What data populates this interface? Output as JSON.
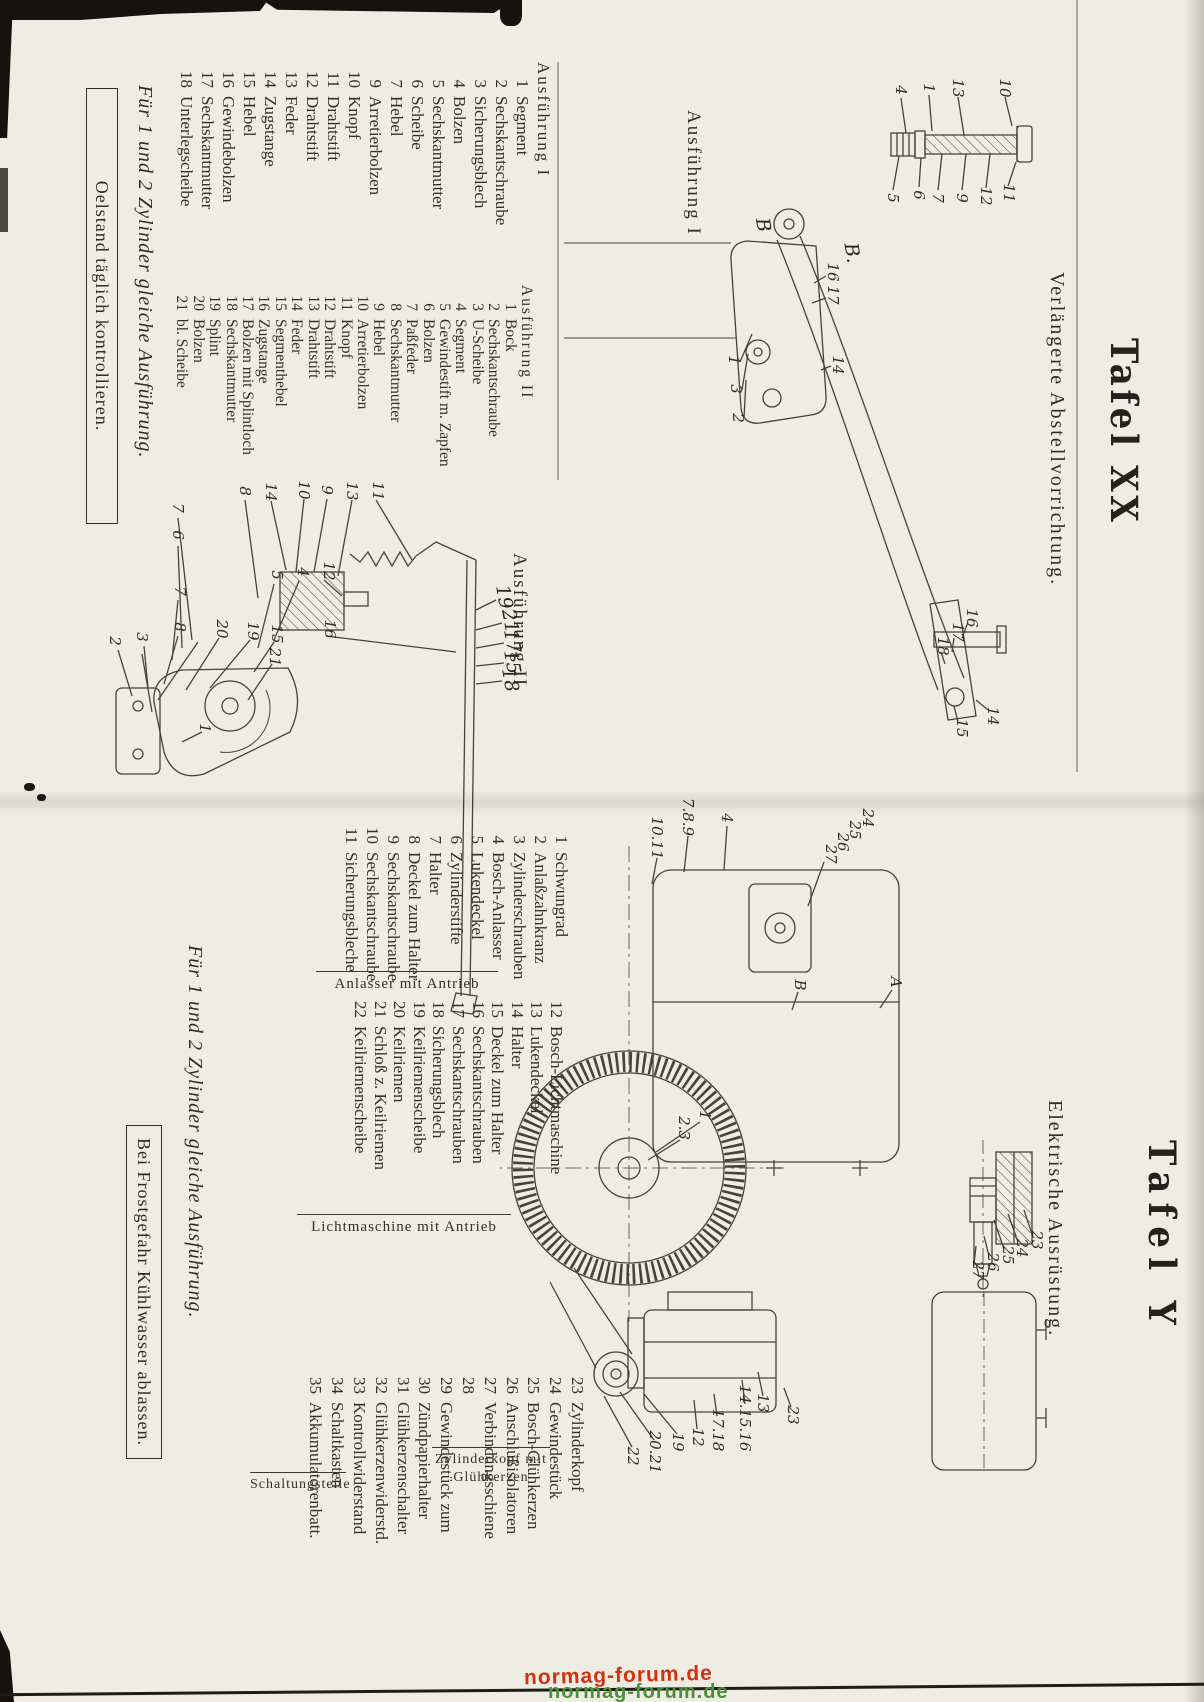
{
  "watermark": {
    "text": "normag-forum.de",
    "red": "#d23110",
    "green": "#4b9138"
  },
  "page_left": {
    "title": "Tafel XX",
    "subtitle": "Verlängerte Abstellvorrichtung.",
    "drawing_labels": {
      "ausf1": "Ausführung I",
      "ausf2": "Ausführung II"
    },
    "list1": {
      "header": "Ausführung I",
      "items": [
        {
          "n": "1",
          "t": "Segment"
        },
        {
          "n": "2",
          "t": "Sechskantschraube"
        },
        {
          "n": "3",
          "t": "Sicherungsblech"
        },
        {
          "n": "4",
          "t": "Bolzen"
        },
        {
          "n": "5",
          "t": "Sechskantmutter"
        },
        {
          "n": "6",
          "t": "Scheibe"
        },
        {
          "n": "7",
          "t": "Hebel"
        },
        {
          "n": "9",
          "t": "Arretierbolzen"
        },
        {
          "n": "10",
          "t": "Knopf"
        },
        {
          "n": "11",
          "t": "Drahtstift"
        },
        {
          "n": "12",
          "t": "Drahtstift"
        },
        {
          "n": "13",
          "t": "Feder"
        },
        {
          "n": "14",
          "t": "Zugstange"
        },
        {
          "n": "15",
          "t": "Hebel"
        },
        {
          "n": "16",
          "t": "Gewindebolzen"
        },
        {
          "n": "17",
          "t": "Sechskantmutter"
        },
        {
          "n": "18",
          "t": "Unterlegscheibe"
        }
      ]
    },
    "list2": {
      "header": "Ausführung II",
      "items": [
        {
          "n": "1",
          "t": "Bock"
        },
        {
          "n": "2",
          "t": "Sechskantschraube"
        },
        {
          "n": "3",
          "t": "U-Scheibe"
        },
        {
          "n": "4",
          "t": "Segment"
        },
        {
          "n": "5",
          "t": "Gewindestift m. Zapfen"
        },
        {
          "n": "6",
          "t": "Bolzen"
        },
        {
          "n": "7",
          "t": "Paßfeder"
        },
        {
          "n": "8",
          "t": "Sechskantmutter"
        },
        {
          "n": "9",
          "t": "Hebel"
        },
        {
          "n": "10",
          "t": "Arretierbolzen"
        },
        {
          "n": "11",
          "t": "Knopf"
        },
        {
          "n": "12",
          "t": "Drahtstift"
        },
        {
          "n": "13",
          "t": "Drahtstift"
        },
        {
          "n": "14",
          "t": "Feder"
        },
        {
          "n": "15",
          "t": "Segmenthebel"
        },
        {
          "n": "16",
          "t": "Zugstange"
        },
        {
          "n": "17",
          "t": "Bolzen mit Splintloch"
        },
        {
          "n": "18",
          "t": "Sechskantmutter"
        },
        {
          "n": "19",
          "t": "Splint"
        },
        {
          "n": "20",
          "t": "Bolzen"
        },
        {
          "n": "21",
          "t": "bl. Scheibe"
        }
      ]
    },
    "note_italic": "Für 1 und 2 Zylinder gleiche Ausführung.",
    "note_boxed": "Oelstand täglich kontrollieren.",
    "callouts": [
      {
        "t": "10",
        "x": 88,
        "y": 199
      },
      {
        "t": "13",
        "x": 88,
        "y": 246
      },
      {
        "t": "1",
        "x": 88,
        "y": 275
      },
      {
        "t": "4",
        "x": 90,
        "y": 303
      },
      {
        "t": "11",
        "x": 193,
        "y": 195
      },
      {
        "t": "12",
        "x": 196,
        "y": 218
      },
      {
        "t": "9",
        "x": 198,
        "y": 242
      },
      {
        "t": "7",
        "x": 198,
        "y": 266
      },
      {
        "t": "6",
        "x": 195,
        "y": 285
      },
      {
        "t": "5",
        "x": 198,
        "y": 311
      },
      {
        "t": "16",
        "x": 272,
        "y": 371
      },
      {
        "t": "17",
        "x": 295,
        "y": 371
      },
      {
        "t": "14",
        "x": 365,
        "y": 366
      },
      {
        "t": "1",
        "x": 360,
        "y": 470
      },
      {
        "t": "3",
        "x": 389,
        "y": 468
      },
      {
        "t": "2",
        "x": 418,
        "y": 466
      },
      {
        "t": "16",
        "x": 618,
        "y": 232
      },
      {
        "t": "17",
        "x": 632,
        "y": 246
      },
      {
        "t": "18",
        "x": 646,
        "y": 261
      },
      {
        "t": "14",
        "x": 716,
        "y": 211
      },
      {
        "t": "15",
        "x": 728,
        "y": 242
      },
      {
        "t": "11",
        "x": 491,
        "y": 826
      },
      {
        "t": "13",
        "x": 491,
        "y": 852
      },
      {
        "t": "9",
        "x": 490,
        "y": 877
      },
      {
        "t": "10",
        "x": 490,
        "y": 900
      },
      {
        "t": "14",
        "x": 492,
        "y": 933
      },
      {
        "t": "8",
        "x": 491,
        "y": 959
      },
      {
        "t": "12",
        "x": 571,
        "y": 875
      },
      {
        "t": "4",
        "x": 572,
        "y": 901
      },
      {
        "t": "5",
        "x": 575,
        "y": 927
      },
      {
        "t": "16",
        "x": 629,
        "y": 874
      },
      {
        "t": "15",
        "x": 634,
        "y": 927
      },
      {
        "t": "19",
        "x": 631,
        "y": 951
      },
      {
        "t": "21",
        "x": 657,
        "y": 929
      },
      {
        "t": "20",
        "x": 629,
        "y": 982
      },
      {
        "t": "7",
        "x": 508,
        "y": 1026
      },
      {
        "t": "6",
        "x": 535,
        "y": 1026
      },
      {
        "t": "7",
        "x": 591,
        "y": 1024
      },
      {
        "t": "8",
        "x": 627,
        "y": 1024
      },
      {
        "t": "3",
        "x": 637,
        "y": 1062
      },
      {
        "t": "2",
        "x": 641,
        "y": 1089
      },
      {
        "t": "1",
        "x": 728,
        "y": 999
      }
    ],
    "hand_marks": [
      {
        "t": "19",
        "x": 597,
        "y": 700
      },
      {
        "t": "21",
        "x": 621,
        "y": 694
      },
      {
        "t": "17",
        "x": 641,
        "y": 692
      },
      {
        "t": "15",
        "x": 662,
        "y": 692
      },
      {
        "t": "18",
        "x": 680,
        "y": 694
      },
      {
        "t": "B",
        "x": 225,
        "y": 441
      },
      {
        "t": "B.",
        "x": 253,
        "y": 352
      }
    ]
  },
  "page_right": {
    "title": "Tafel Y",
    "subtitle": "Elektrische Ausrüstung.",
    "list_starter": {
      "caption": "Anlasser mit Antrieb",
      "items": [
        {
          "n": "1",
          "t": "Schwungrad"
        },
        {
          "n": "2",
          "t": "Anlaßzahnkranz"
        },
        {
          "n": "3",
          "t": "Zylinderschrauben"
        },
        {
          "n": "4",
          "t": "Bosch-Anlasser"
        },
        {
          "n": "5",
          "t": "Lukendeckel"
        },
        {
          "n": "6",
          "t": "Zylinderstifte"
        },
        {
          "n": "7",
          "t": "Halter"
        },
        {
          "n": "8",
          "t": "Deckel zum Halter"
        },
        {
          "n": "9",
          "t": "Sechskantschraube"
        },
        {
          "n": "10",
          "t": "Sechskantschraube"
        },
        {
          "n": "11",
          "t": "Sicherungsbleche"
        }
      ]
    },
    "list_dynamo": {
      "caption": "Lichtmaschine mit Antrieb",
      "items": [
        {
          "n": "12",
          "t": "Bosch-Lichtmaschine"
        },
        {
          "n": "13",
          "t": "Lukendeckel"
        },
        {
          "n": "14",
          "t": "Halter"
        },
        {
          "n": "15",
          "t": "Deckel zum Halter"
        },
        {
          "n": "16",
          "t": "Sechskantschrauben"
        },
        {
          "n": "17",
          "t": "Sechskantschrauben"
        },
        {
          "n": "18",
          "t": "Sicherungsblech"
        },
        {
          "n": "19",
          "t": "Keilriemenscheibe"
        },
        {
          "n": "20",
          "t": "Keilriemen"
        },
        {
          "n": "21",
          "t": "Schloß z. Keilriemen"
        },
        {
          "n": "22",
          "t": "Keilriemenscheibe"
        }
      ]
    },
    "list_parts": {
      "caption_a": "Schaltungsteile",
      "caption_b_line1": "Zylinderkopf mit",
      "caption_b_line2": "Glühkerzen",
      "items": [
        {
          "n": "23",
          "t": "Zylinderkopf"
        },
        {
          "n": "24",
          "t": "Gewindestück"
        },
        {
          "n": "25",
          "t": "Bosch-Glühkerzen"
        },
        {
          "n": "26",
          "t": "Anschlußisolatoren"
        },
        {
          "n": "27",
          "t": "Verbindungsschiene"
        },
        {
          "n": "28",
          "t": ""
        },
        {
          "n": "29",
          "t": "Gewindestück zum"
        },
        {
          "n": "30",
          "t": "Zündpapierhalter"
        },
        {
          "n": "31",
          "t": "Glühkerzenschalter"
        },
        {
          "n": "32",
          "t": "Glühkerzenwiderstd."
        },
        {
          "n": "33",
          "t": "Kontrollwiderstand"
        },
        {
          "n": "34",
          "t": "Schaltkasten"
        },
        {
          "n": "35",
          "t": "Akkumulatorenbatt."
        }
      ]
    },
    "note_italic": "Für 1 und 2 Zylinder gleiche Ausführung.",
    "note_boxed": "Bei Frostgefahr Kühlwasser ablassen.",
    "callouts": [
      {
        "t": "7.8.9",
        "x": 817,
        "y": 516
      },
      {
        "t": "10.11",
        "x": 838,
        "y": 547
      },
      {
        "t": "4",
        "x": 818,
        "y": 477
      },
      {
        "t": "24",
        "x": 818,
        "y": 336
      },
      {
        "t": "25",
        "x": 830,
        "y": 349
      },
      {
        "t": "26",
        "x": 842,
        "y": 361
      },
      {
        "t": "27",
        "x": 854,
        "y": 373
      },
      {
        "t": "A",
        "x": 982,
        "y": 308
      },
      {
        "t": "B",
        "x": 985,
        "y": 404
      },
      {
        "t": "1",
        "x": 1115,
        "y": 499
      },
      {
        "t": "2.3",
        "x": 1128,
        "y": 520
      },
      {
        "t": "23",
        "x": 1240,
        "y": 167
      },
      {
        "t": "24",
        "x": 1248,
        "y": 182
      },
      {
        "t": "25",
        "x": 1255,
        "y": 196
      },
      {
        "t": "26",
        "x": 1262,
        "y": 211
      },
      {
        "t": "27",
        "x": 1270,
        "y": 226
      },
      {
        "t": "13",
        "x": 1403,
        "y": 441
      },
      {
        "t": "14.15.16",
        "x": 1418,
        "y": 459
      },
      {
        "t": "23",
        "x": 1415,
        "y": 411
      },
      {
        "t": "17.18",
        "x": 1430,
        "y": 486
      },
      {
        "t": "12",
        "x": 1437,
        "y": 506
      },
      {
        "t": "19",
        "x": 1442,
        "y": 526
      },
      {
        "t": "20.21",
        "x": 1452,
        "y": 549
      },
      {
        "t": "22",
        "x": 1456,
        "y": 571
      }
    ]
  }
}
